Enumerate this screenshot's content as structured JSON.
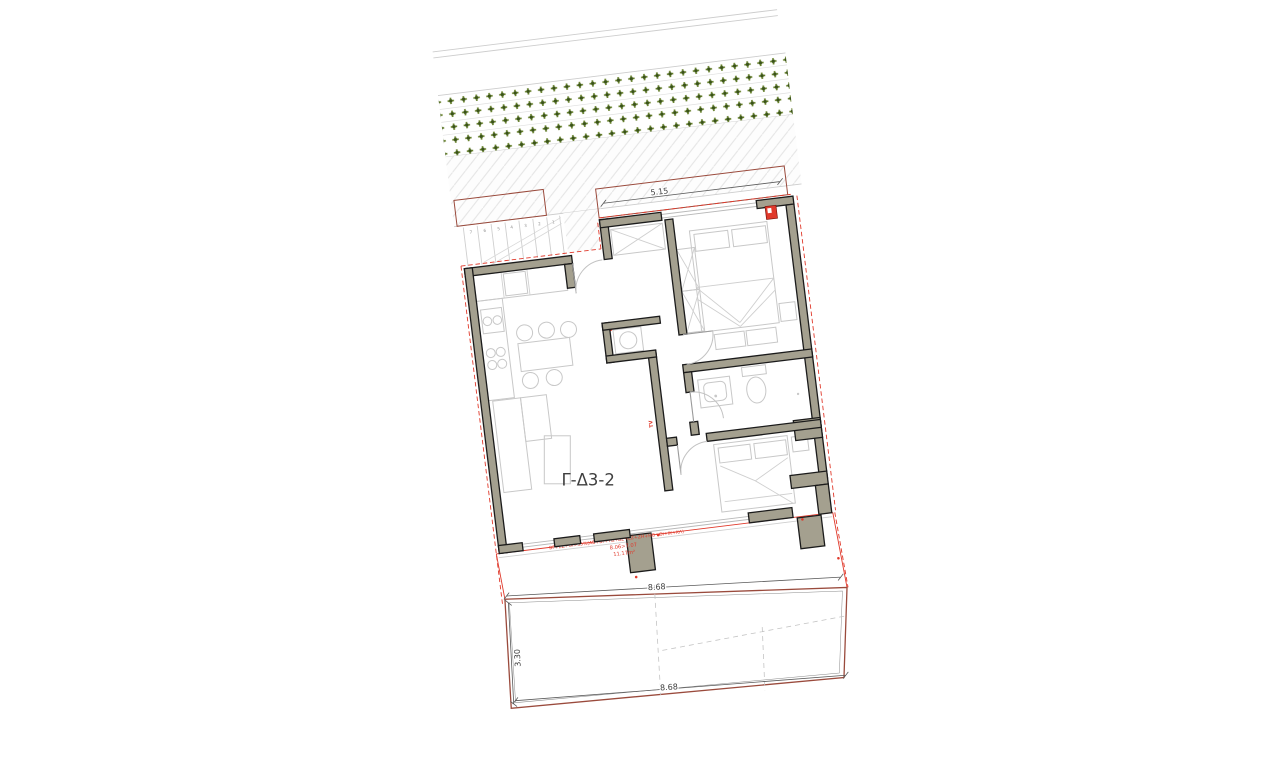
{
  "plan": {
    "apartment_label": "Γ-Δ3-2",
    "tv_label": "TV",
    "balcony_note": {
      "formula": "ΒΓ+ΕΖ+ΘΙ>35%(ΑΒ+ΒΓ+ΓΔ+ΔΕ+ΕΖ+ΖΗ+ΗΘ+ΘΙ+ΙΚ+ΚΛ)",
      "comparison": "8.06>7.07",
      "area": "11.17m²"
    },
    "dimensions": {
      "planter_strip_length": "5.15",
      "garden_width_upper": "8.68",
      "garden_width_lower": "8.68",
      "garden_depth_left": "3.30"
    },
    "stairs": {
      "steps": [
        "1",
        "2",
        "3",
        "4",
        "5",
        "6",
        "7"
      ]
    },
    "colors": {
      "wall_fill": "#a4a08f",
      "wall_outline": "#1b1b1b",
      "furniture_line": "#c8c8c8",
      "red_accent": "#e0392b",
      "boundary_brick": "#9a4a3c",
      "plant_green": "#66802a",
      "plant_green_dark": "#39521a",
      "dim_text": "#3d3d3d",
      "paving_line": "#e4e4e4"
    }
  }
}
